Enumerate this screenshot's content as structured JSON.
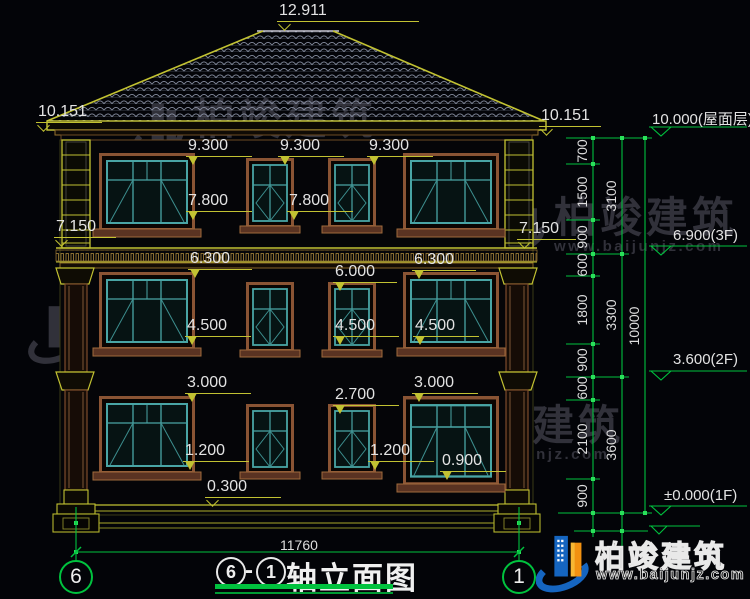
{
  "colors": {
    "background": "#030408",
    "line_yellow": "#c2c232",
    "line_green": "#00c23e",
    "window_teal": "#49a5a5",
    "casing_brown": "#8a5434",
    "dim_text": "#e3e3e3",
    "watermark_gray": "#34343d",
    "logo_blue": "#1565c0",
    "logo_orange": "#f29111"
  },
  "facade_marks": {
    "roof_peak": "12.911",
    "eave_left": "10.151",
    "eave_right": "10.151",
    "cornice_left": "7.150",
    "cornice_right": "7.150",
    "f3_tops": [
      "9.300",
      "9.300",
      "9.300"
    ],
    "f3_sills": [
      "7.800",
      "7.800"
    ],
    "f2_tops": [
      "6.300",
      "6.000",
      "6.300"
    ],
    "f2_sills": [
      "4.500",
      "4.500",
      "4.500"
    ],
    "f1_tops": [
      "3.000",
      "2.700",
      "3.000"
    ],
    "f1_sills": [
      "1.200",
      "1.200",
      "0.900"
    ],
    "plinth": "0.300"
  },
  "right_dims": {
    "segments": [
      "700",
      "1500",
      "900",
      "600",
      "1800",
      "900",
      "600",
      "2100",
      "900"
    ],
    "subtotals": [
      "3100",
      "3300",
      "3600"
    ],
    "total": "10000",
    "levels": [
      "10.000(屋面层)",
      "6.900(3F)",
      "3.600(2F)",
      "±0.000(1F)"
    ]
  },
  "bottom": {
    "overall_width": "11760",
    "axis_left": "6",
    "axis_right": "1"
  },
  "title_block": {
    "axis_a": "6",
    "separator": "-",
    "axis_b": "1",
    "name": "轴立面图"
  },
  "watermark": {
    "name": "柏竣建筑",
    "url": "www.baijunjz.com"
  },
  "logo": {
    "name": "柏竣建筑",
    "url": "www.baijunjz.com"
  }
}
